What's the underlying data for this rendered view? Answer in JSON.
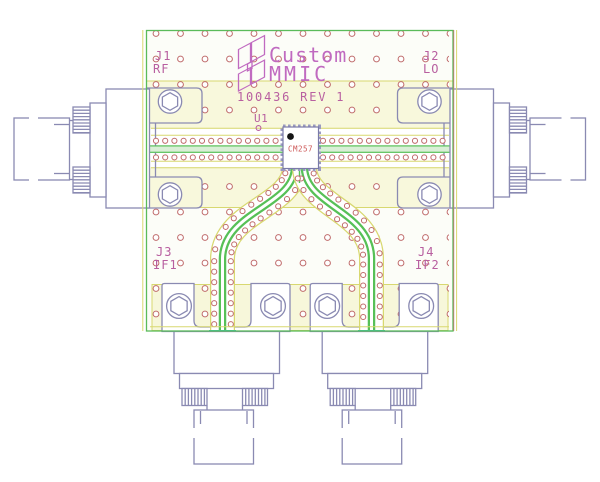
{
  "drawing": {
    "logo": {
      "line1": "Custom",
      "line2": "MMIC"
    },
    "title_block": "100436 REV 1",
    "chip": {
      "refdes": "U1",
      "part": "CM257"
    },
    "connectors": [
      {
        "refdes": "J1",
        "signal": "RF"
      },
      {
        "refdes": "J2",
        "signal": "LO"
      },
      {
        "refdes": "J3",
        "signal": "IF1"
      },
      {
        "refdes": "J4",
        "signal": "IF2"
      }
    ],
    "colors": {
      "board_outline_green": "#5ABB5A",
      "trace_green": "#57C057",
      "keepout_yellow": "#D8D870",
      "pour_fill_yellow": "#F8F8DC",
      "via_red": "#BF6A6A",
      "silkscreen_magenta": "#B85FA0",
      "logo_magenta": "#C06AC0",
      "connector_slate": "#8A8AB2",
      "chip_text_red": "#CC5555",
      "board_edge_cyan": "#35C8C8"
    }
  }
}
